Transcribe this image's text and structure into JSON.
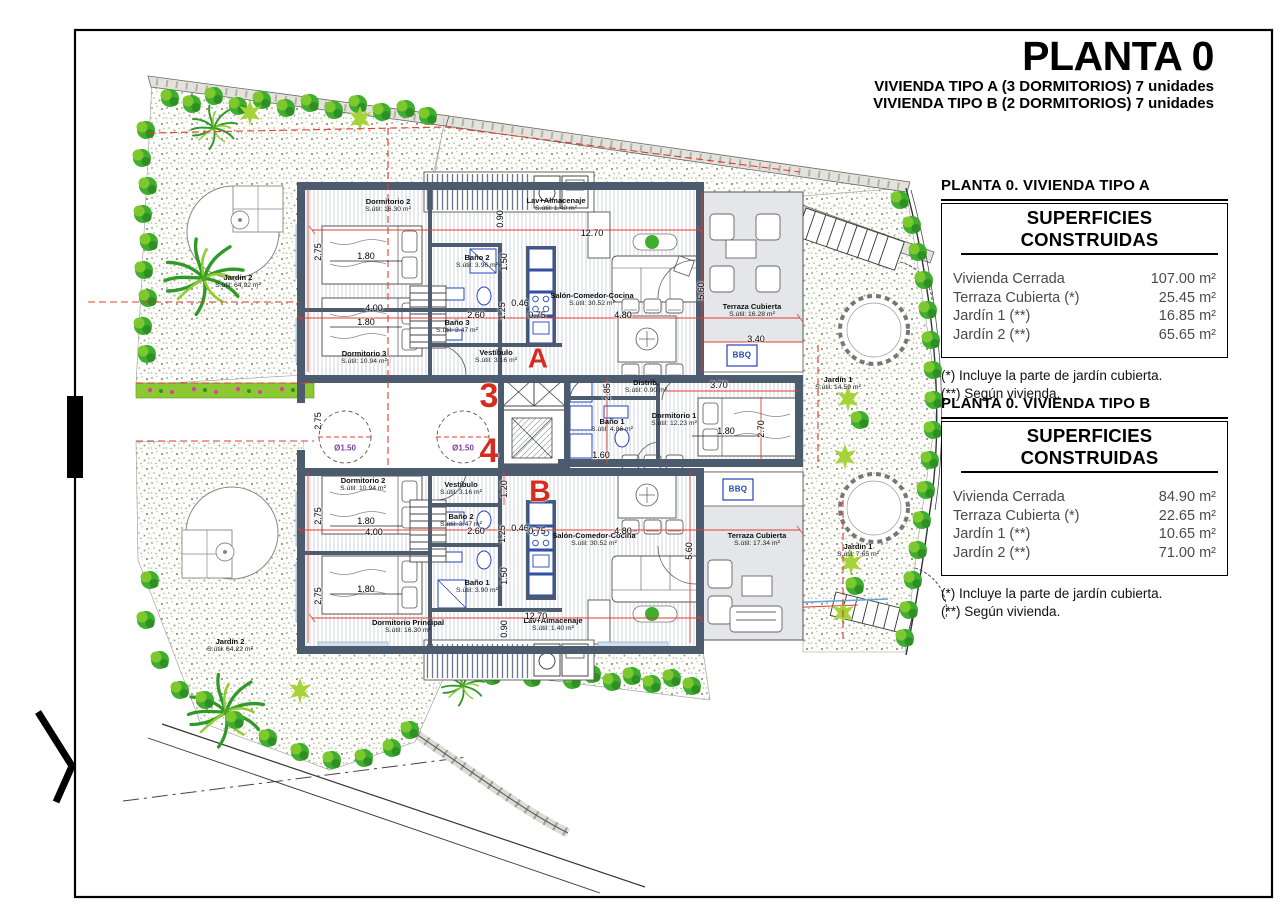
{
  "frame": {
    "title": "PLANTA 0",
    "subtitle1": "VIVIENDA TIPO A (3 DORMITORIOS) 7 unidades",
    "subtitle2": "VIVIENDA TIPO B (2 DORMITORIOS) 7 unidades"
  },
  "tables": [
    {
      "heading": "PLANTA 0. VIVIENDA TIPO A",
      "box_title": "SUPERFICIES CONSTRUIDAS",
      "rows": [
        {
          "label": "Vivienda Cerrada",
          "value": "107.00 m²"
        },
        {
          "label": "Terraza Cubierta  (*)",
          "value": "25.45 m²"
        },
        {
          "label": "Jardín 1 (**)",
          "value": "16.85 m²"
        },
        {
          "label": "Jardín 2 (**)",
          "value": "65.65 m²"
        }
      ],
      "notes": [
        "(*)  Incluye la parte de jardín cubierta.",
        "(**) Según vivienda."
      ]
    },
    {
      "heading": "PLANTA 0. VIVIENDA TIPO B",
      "box_title": "SUPERFICIES CONSTRUIDAS",
      "rows": [
        {
          "label": "Vivienda Cerrada",
          "value": "84.90 m²"
        },
        {
          "label": "Terraza Cubierta (*)",
          "value": "22.65 m²"
        },
        {
          "label": "Jardín 1 (**)",
          "value": "10.65 m²"
        },
        {
          "label": "Jardín 2 (**)",
          "value": "71.00 m²"
        }
      ],
      "notes": [
        "(*) Incluye la parte de jardín cubierta.",
        "(**) Según vivienda."
      ]
    }
  ],
  "plan": {
    "markers": [
      {
        "t": "A",
        "x": 538,
        "y": 358,
        "size": 28
      },
      {
        "t": "B",
        "x": 540,
        "y": 492,
        "size": 30
      },
      {
        "t": "3",
        "x": 489,
        "y": 396,
        "size": 34
      },
      {
        "t": "4",
        "x": 489,
        "y": 451,
        "size": 34
      }
    ],
    "rooms": [
      {
        "name": "Dormitorio 2",
        "area": "S.útil: 16.30 m²",
        "x": 388,
        "y": 206
      },
      {
        "name": "Lav+Almacenaje",
        "area": "S.útil: 1.40 m²",
        "x": 556,
        "y": 205
      },
      {
        "name": "Baño 2",
        "area": "S.útil: 3.96 m²",
        "x": 477,
        "y": 262
      },
      {
        "name": "Salón-Comedor-Cocina",
        "area": "S.útil: 30.52 m²",
        "x": 592,
        "y": 300
      },
      {
        "name": "Terraza Cubierta",
        "area": "S.útil: 16.28 m²",
        "x": 752,
        "y": 311
      },
      {
        "name": "Baño 3",
        "area": "S.útil: 3.47 m²",
        "x": 457,
        "y": 327
      },
      {
        "name": "Dormitorio 3",
        "area": "S.útil: 10.94 m²",
        "x": 364,
        "y": 358
      },
      {
        "name": "Vestíbulo",
        "area": "S.útil: 3.16 m²",
        "x": 496,
        "y": 357
      },
      {
        "name": "Distrib.",
        "area": "S.útil: 0.90 m²",
        "x": 646,
        "y": 387
      },
      {
        "name": "Baño 1",
        "area": "S.útil: 4.86 m²",
        "x": 612,
        "y": 426
      },
      {
        "name": "Dormitorio 1",
        "area": "S.útil: 12.23 m²",
        "x": 674,
        "y": 420
      },
      {
        "name": "Jardín 1",
        "area": "S.útil: 14.59 m²",
        "x": 838,
        "y": 384
      },
      {
        "name": "Jardín 2",
        "area": "S.útil: 64.92 m²",
        "x": 238,
        "y": 282
      },
      {
        "name": "Vestíbulo",
        "area": "S.útil: 3.16 m²",
        "x": 461,
        "y": 489
      },
      {
        "name": "Dormitorio 2",
        "area": "S.útil: 10.94 m²",
        "x": 363,
        "y": 485
      },
      {
        "name": "Baño 2",
        "area": "S.útil: 3.47 m²",
        "x": 461,
        "y": 521
      },
      {
        "name": "Salón-Comedor-Cocina",
        "area": "S.útil: 30.52 m²",
        "x": 594,
        "y": 540
      },
      {
        "name": "Terraza Cubierta",
        "area": "S.útil: 17.34 m²",
        "x": 757,
        "y": 540
      },
      {
        "name": "Baño 1",
        "area": "S.útil: 3.90 m²",
        "x": 477,
        "y": 587
      },
      {
        "name": "Dormitorio Principal",
        "area": "S.útil: 16.30 m²",
        "x": 408,
        "y": 627
      },
      {
        "name": "Lav+Almacenaje",
        "area": "S.útil: 1.40 m²",
        "x": 553,
        "y": 625
      },
      {
        "name": "Jardín 1",
        "area": "S.útil: 7.65 m²",
        "x": 858,
        "y": 551
      },
      {
        "name": "Jardín 2",
        "area": "S.útil: 64.22 m²",
        "x": 230,
        "y": 646
      }
    ],
    "dims": [
      {
        "t": "12.70",
        "x": 592,
        "y": 233
      },
      {
        "t": "0.90",
        "x": 500,
        "y": 219,
        "v": true
      },
      {
        "t": "2.75",
        "x": 318,
        "y": 252,
        "v": true
      },
      {
        "t": "1.80",
        "x": 366,
        "y": 256
      },
      {
        "t": "1.50",
        "x": 504,
        "y": 262,
        "v": true
      },
      {
        "t": "5.60",
        "x": 701,
        "y": 291,
        "v": true
      },
      {
        "t": "0.46",
        "x": 520,
        "y": 303
      },
      {
        "t": "4.00",
        "x": 374,
        "y": 308
      },
      {
        "t": "1.25",
        "x": 502,
        "y": 311,
        "v": true
      },
      {
        "t": "2.60",
        "x": 476,
        "y": 315
      },
      {
        "t": "0.75",
        "x": 537,
        "y": 315
      },
      {
        "t": "4.80",
        "x": 623,
        "y": 315
      },
      {
        "t": "1.80",
        "x": 366,
        "y": 322
      },
      {
        "t": "3.40",
        "x": 756,
        "y": 339
      },
      {
        "t": "2.75",
        "x": 318,
        "y": 421,
        "v": true
      },
      {
        "t": "2.85",
        "x": 607,
        "y": 392,
        "v": true
      },
      {
        "t": "3.70",
        "x": 719,
        "y": 385
      },
      {
        "t": "1.60",
        "x": 601,
        "y": 455
      },
      {
        "t": "1.80",
        "x": 726,
        "y": 431
      },
      {
        "t": "2.70",
        "x": 761,
        "y": 429,
        "v": true
      },
      {
        "t": "1.20",
        "x": 504,
        "y": 489,
        "v": true
      },
      {
        "t": "1.80",
        "x": 366,
        "y": 521
      },
      {
        "t": "2.75",
        "x": 318,
        "y": 516,
        "v": true
      },
      {
        "t": "4.00",
        "x": 374,
        "y": 532
      },
      {
        "t": "2.60",
        "x": 476,
        "y": 531
      },
      {
        "t": "1.25",
        "x": 502,
        "y": 534,
        "v": true
      },
      {
        "t": "0.46",
        "x": 520,
        "y": 528
      },
      {
        "t": "0.75",
        "x": 537,
        "y": 531
      },
      {
        "t": "4.80",
        "x": 623,
        "y": 531
      },
      {
        "t": "5.60",
        "x": 689,
        "y": 551,
        "v": true
      },
      {
        "t": "1.50",
        "x": 504,
        "y": 576,
        "v": true
      },
      {
        "t": "1.80",
        "x": 366,
        "y": 589
      },
      {
        "t": "2.75",
        "x": 318,
        "y": 596,
        "v": true
      },
      {
        "t": "12.70",
        "x": 536,
        "y": 616
      },
      {
        "t": "0.90",
        "x": 504,
        "y": 629,
        "v": true
      }
    ],
    "special_labels": [
      {
        "text": "BBQ",
        "x": 742,
        "y": 356,
        "kind": "bbq"
      },
      {
        "text": "BBQ",
        "x": 738,
        "y": 490,
        "kind": "bbq"
      },
      {
        "text": "Ø1.50",
        "x": 345,
        "y": 449,
        "kind": "diam"
      },
      {
        "text": "Ø1.50",
        "x": 463,
        "y": 449,
        "kind": "diam"
      }
    ],
    "colors": {
      "wall": "#4d5b6e",
      "terrace": "#e4e6e9",
      "dimension_red": "#e03c31",
      "marker_red": "#d62b1f",
      "fixture_blue": "#2244bb",
      "diameter_purple": "#8040a0",
      "vegetation_green": "#3fae2f"
    }
  }
}
